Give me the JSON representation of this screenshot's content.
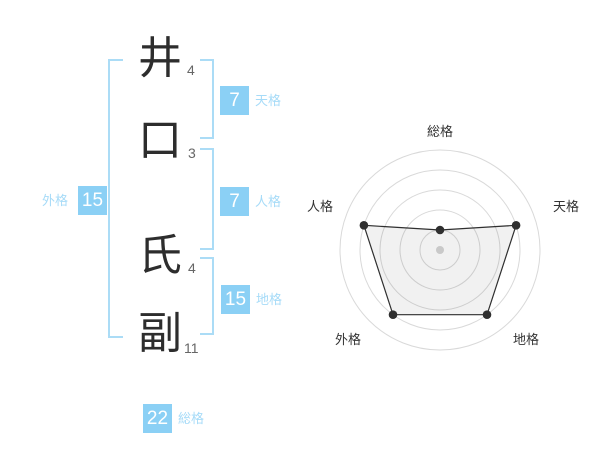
{
  "name_diagram": {
    "characters": [
      {
        "char": "井",
        "strokes": "4"
      },
      {
        "char": "口",
        "strokes": "3"
      },
      {
        "char": "氏",
        "strokes": "4"
      },
      {
        "char": "副",
        "strokes": "11"
      }
    ],
    "fortune_numbers": {
      "tenkaku": {
        "label": "天格",
        "value": "7"
      },
      "jinkaku": {
        "label": "人格",
        "value": "7"
      },
      "chikaku": {
        "label": "地格",
        "value": "15"
      },
      "gaikaku": {
        "label": "外格",
        "value": "15"
      },
      "soukaku": {
        "label": "総格",
        "value": "22"
      }
    }
  },
  "colors": {
    "value_box_blue": "#8bd0f5",
    "label_blue": "#a6dbf8",
    "bracket_blue": "#abdcf6",
    "grid_gray": "#d9d9d9",
    "line_dark": "#2f2f2f",
    "center_dot_gray": "#c9c9c9"
  },
  "chart_data": {
    "type": "radar",
    "title": "",
    "axes": [
      "総格",
      "天格",
      "地格",
      "外格",
      "人格"
    ],
    "values": [
      20,
      80,
      80,
      80,
      80
    ],
    "max": 100,
    "ring_interval": 20,
    "rings": 5,
    "axis_arrangement": "clockwise from top",
    "grid": "5 concentric circles, no spokes",
    "legend": "none"
  }
}
